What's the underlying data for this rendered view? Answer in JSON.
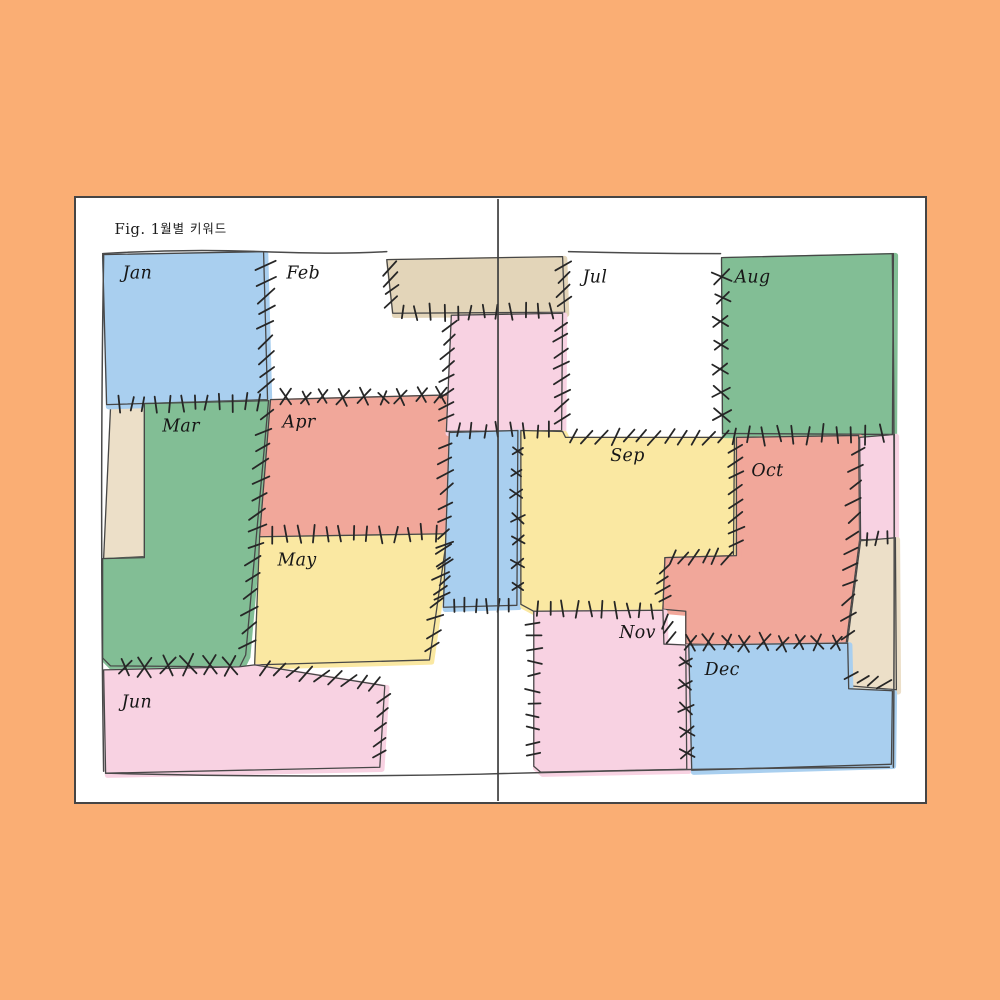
{
  "figure_caption": {
    "label": "Fig. 1.",
    "title_korean": "월별 키워드"
  },
  "months": [
    {
      "id": "jan",
      "label": "Jan",
      "color": "#A9CFEF"
    },
    {
      "id": "feb",
      "label": "Feb",
      "color": "#FFFFFF"
    },
    {
      "id": "mar",
      "label": "Mar",
      "color": "#82BE95"
    },
    {
      "id": "apr",
      "label": "Apr",
      "color": "#F1A79A"
    },
    {
      "id": "may",
      "label": "May",
      "color": "#FAE8A2"
    },
    {
      "id": "jun",
      "label": "Jun",
      "color": "#F8D2E2"
    },
    {
      "id": "jul",
      "label": "Jul",
      "color": "#FFFFFF"
    },
    {
      "id": "aug",
      "label": "Aug",
      "color": "#82BE95"
    },
    {
      "id": "sep",
      "label": "Sep",
      "color": "#FAE8A2"
    },
    {
      "id": "oct",
      "label": "Oct",
      "color": "#F1A79A"
    },
    {
      "id": "nov",
      "label": "Nov",
      "color": "#F8D2E2"
    },
    {
      "id": "dec",
      "label": "Dec",
      "color": "#A9CFEF"
    }
  ],
  "unlabeled_patches": [
    {
      "id": "top-tan",
      "color": "#E3D5B9"
    },
    {
      "id": "top-pink",
      "color": "#F8D2E2"
    },
    {
      "id": "left-tan",
      "color": "#ECDFC8"
    },
    {
      "id": "center-blue",
      "color": "#A9CFEF"
    },
    {
      "id": "right-pink",
      "color": "#F8D2E2"
    },
    {
      "id": "right-tan",
      "color": "#ECDFC8"
    }
  ],
  "colors": {
    "background": "#FAAE74",
    "page": "#FFFFFF",
    "ink": "#474747",
    "stitch": "#262626",
    "text": "#161616"
  }
}
